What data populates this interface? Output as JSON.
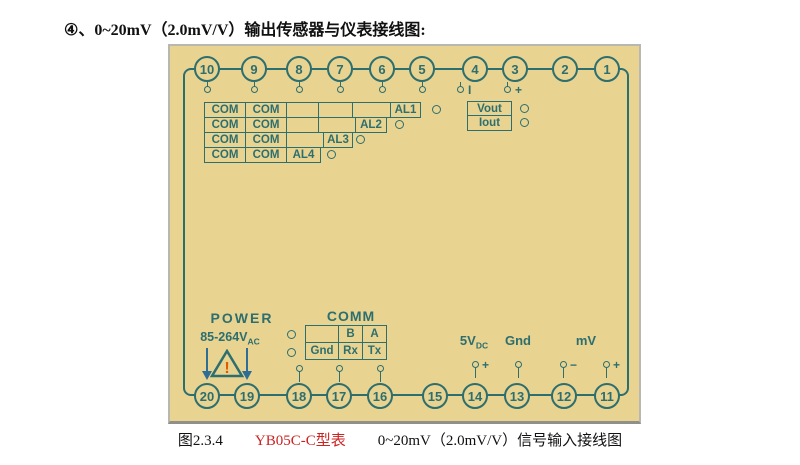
{
  "page": {
    "title": "④、0~20mV（2.0mV/V）输出传感器与仪表接线图:",
    "caption": {
      "figure_no": "图2.3.4",
      "model": "YB05C-C型表",
      "description": "0~20mV（2.0mV/V）信号输入接线图"
    }
  },
  "colors": {
    "panel_background": "#e8d391",
    "diagram_line": "#2d6e6e",
    "model_text_red": "#cc2222",
    "warning_exclamation": "#e05a00",
    "panel_border_gray": "#b8b8b0"
  },
  "terminals": {
    "top": [
      "10",
      "9",
      "8",
      "7",
      "6",
      "5",
      "4",
      "3",
      "2",
      "1"
    ],
    "bottom": [
      "20",
      "19",
      "18",
      "17",
      "16",
      "15",
      "14",
      "13",
      "12",
      "11"
    ]
  },
  "terminal_marks": {
    "t4": "I",
    "t3": "+",
    "t14": "+",
    "t12": "−",
    "t11": "+"
  },
  "alarm_grid": {
    "rows": [
      {
        "cells": [
          "COM",
          "COM",
          "",
          "",
          "",
          "AL1"
        ]
      },
      {
        "cells": [
          "COM",
          "COM",
          "",
          "",
          "AL2"
        ]
      },
      {
        "cells": [
          "COM",
          "COM",
          "",
          "AL3"
        ]
      },
      {
        "cells": [
          "COM",
          "COM",
          "AL4"
        ]
      }
    ]
  },
  "outputs": {
    "vout": "Vout",
    "iout": "Iout"
  },
  "power": {
    "label": "POWER",
    "voltage": "85-264V",
    "voltage_sub": "AC",
    "warning_mark": "!"
  },
  "comm": {
    "label": "COMM",
    "table": {
      "row1": [
        "",
        "B",
        "A"
      ],
      "row2": [
        "Gnd",
        "Rx",
        "Tx"
      ]
    }
  },
  "signals": {
    "supply": "5V",
    "supply_sub": "DC",
    "ground": "Gnd",
    "millivolt": "mV"
  }
}
